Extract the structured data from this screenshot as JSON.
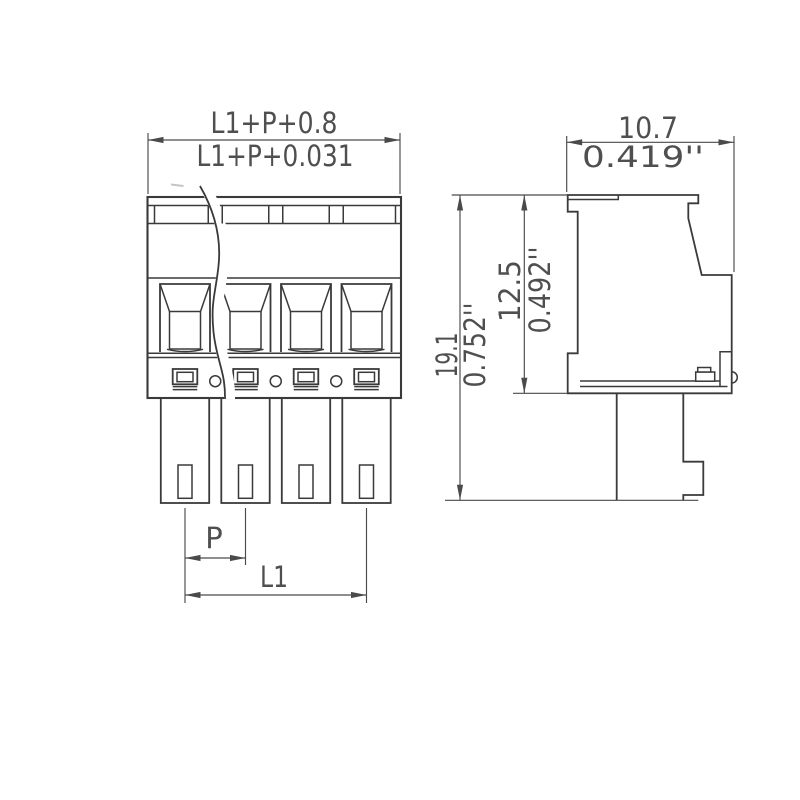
{
  "front_view": {
    "poles": 4,
    "dims": {
      "overall_width_mm": "L1+P+0.8",
      "overall_width_inch": "L1+P+0.031",
      "pitch": "P",
      "length": "L1"
    }
  },
  "side_view": {
    "dims": {
      "depth_mm": "10.7",
      "depth_inch": "0.419''",
      "overall_height_mm": "19.1",
      "overall_height_inch": "0.752''",
      "housing_height_mm": "12.5",
      "housing_height_inch": "0.492''"
    }
  },
  "colors": {
    "line": "#3a3a3a",
    "dimension": "#4a4a4a",
    "text": "#4f4f4f",
    "background": "#ffffff"
  }
}
